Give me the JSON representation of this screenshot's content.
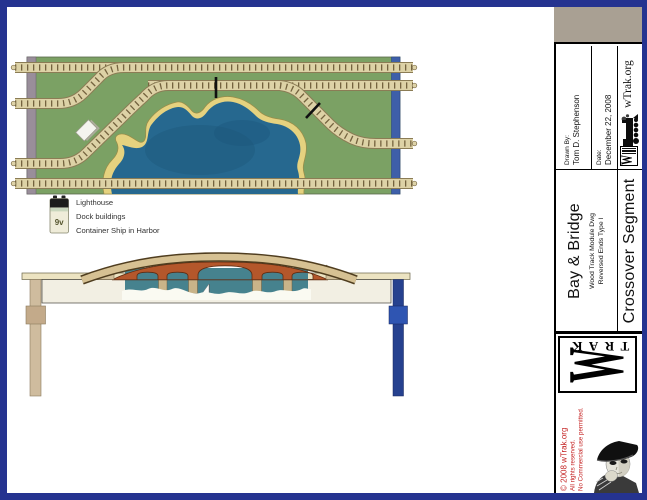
{
  "page": {
    "border_color": "#253390",
    "background": "#ffffff"
  },
  "plan": {
    "legend": {
      "battery_label": "9v",
      "items": [
        "Lighthouse",
        "Dock buildings",
        "Container Ship in Harbor"
      ]
    },
    "colors": {
      "board_green": "#7ba164",
      "water_blue": "#26688f",
      "sand": "#e5d27f",
      "track_ballast": "#ddd2a6",
      "left_end_strip": "#998e9a",
      "right_end_strip": "#3e5fa9"
    }
  },
  "elevation": {
    "colors": {
      "fascia": "#f2efe3",
      "brick": "#b4572b",
      "deck": "#d6c193",
      "water": "#46828e",
      "left_leg": "#cfbc9e",
      "right_leg": "#26418f"
    }
  },
  "title_block": {
    "drawn_by_label": "Drawn By:",
    "drawn_by": "Tom D. Stephenson",
    "date_label": "Date:",
    "date": "December 22, 2008",
    "site": "wTrak.org",
    "title": "Bay & Bridge",
    "subtitle1": "Wood Track Module Dwg",
    "subtitle2": "Reversed Ends Type I",
    "segment": "Crossover Segment",
    "logo_trak": "TRAK",
    "logo_w": "W",
    "copyright": "© 2008 wTrak.org",
    "rights1": "All rights reserved.",
    "rights2": "No Commercial use permitted."
  }
}
